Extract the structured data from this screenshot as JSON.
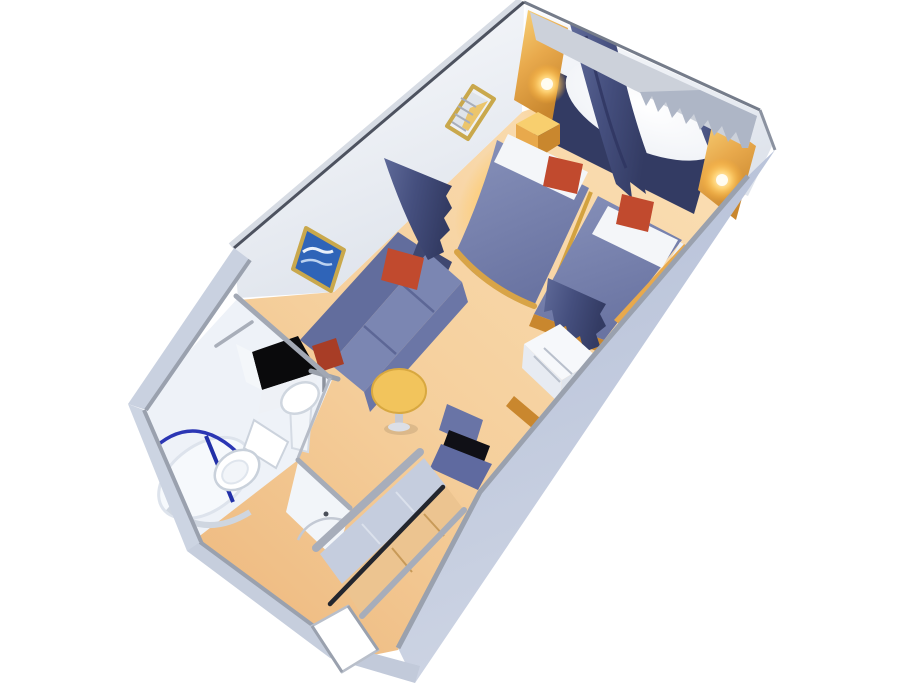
{
  "meta": {
    "title": "Stateroom 3D floor plan",
    "description": "Isometric 3D cutaway rendering of a cruise ship oceanview stateroom with twin beds, sitting area, vanity desk, wardrobe and bathroom"
  },
  "scene": {
    "areas": [
      "sleeping-area",
      "sitting-area",
      "vanity-area",
      "wardrobe",
      "bathroom",
      "shower",
      "entry-corridor"
    ],
    "objects": [
      "twin-bed-left",
      "twin-bed-right",
      "white-pillows",
      "red-throw-pillow-left-bed",
      "red-throw-pillow-right-bed",
      "nightstand",
      "window-light-oval",
      "window-curtain-left",
      "window-curtain-right",
      "headboard-panel",
      "wall-sconce-left",
      "wall-sconce-right",
      "wall-mirror-panel",
      "framed-picture",
      "sofa",
      "sofa-red-pillow-back",
      "sofa-red-pillow-left",
      "privacy-curtain-sofa",
      "privacy-curtain-bed",
      "coffee-table",
      "desk-chair",
      "vanity-drawer-unit",
      "wardrobe-rail",
      "wardrobe-shelves",
      "bathroom-sink",
      "sink-faucet",
      "vanity-counter",
      "toilet",
      "shower-curtain-rail",
      "towel-bar",
      "bathroom-door",
      "entry-door",
      "door-swing-arc"
    ]
  },
  "colors": {
    "background": "#ffffff",
    "exterior_wall": "#b7c1d8",
    "exterior_wall_light": "#cdd4e3",
    "wall_cap": "#9aa1ae",
    "wall_edge_dark": "#4d525f",
    "interior_wall": "#f7f9fc",
    "interior_wall_shade": "#e4e9f1",
    "valance_gray": "#ccd1da",
    "carpet": "#f5cf9c",
    "carpet_deep": "#edb77b",
    "carpet_glow": "#ffc861",
    "gold": "#e8a94c",
    "gold_deep": "#c9872e",
    "gold_light": "#f8cf6e",
    "navy": "#454f7e",
    "navy_deep": "#333b63",
    "bed_cover": "#7d87b0",
    "bed_cover_dark": "#6a74a2",
    "pillow_white": "#f4f6f9",
    "cushion_red": "#c14a2e",
    "cushion_red_dark": "#a83d26",
    "sofa_back": "#626d9d",
    "sofa_seat": "#7b86b2",
    "sofa_front": "#6b76a6",
    "sofa_arm": "#8791ba",
    "table_top": "#f2c45c",
    "table_rim": "#d8a840",
    "chair_blue": "#6974a6",
    "chair_seat": "#5f6aa0",
    "chair_gap": "#101016",
    "closet_panel": "#c5cdde",
    "closet_tan": "#ecc490",
    "rail_dark": "#23262e",
    "bath_floor": "#eef2f8",
    "fixture_white": "#ffffff",
    "fixture_shade": "#ccd3dd",
    "shower_blue": "#2b36b4",
    "picture_blue": "#2f64b8",
    "frame_gold": "#c9a84c",
    "counter_black": "#0a0a0c",
    "door_white": "#ffffff"
  }
}
